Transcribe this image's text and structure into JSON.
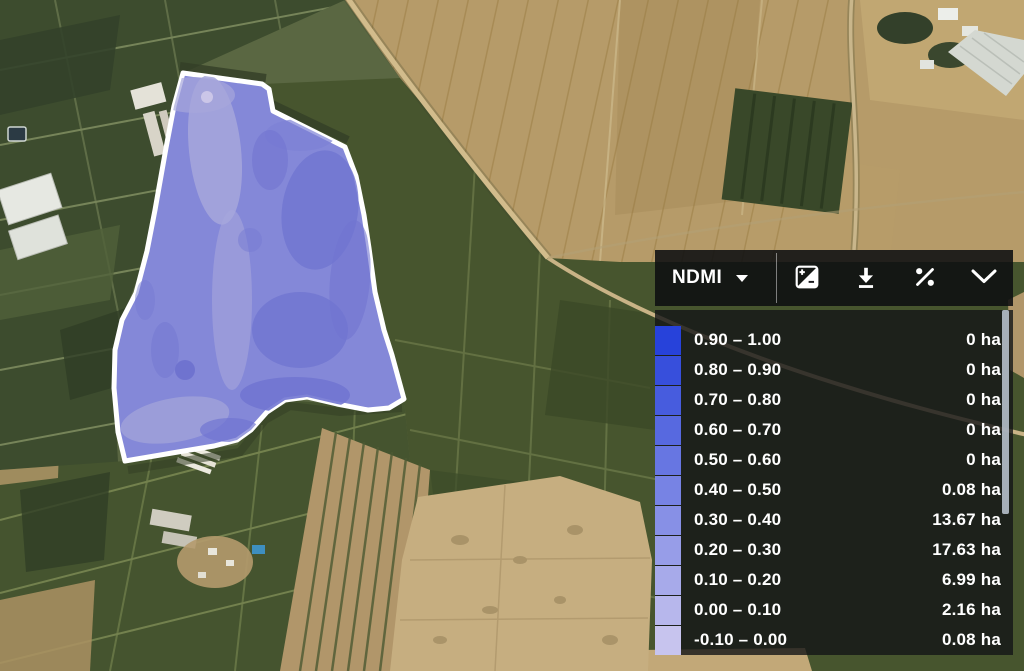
{
  "panel": {
    "layer_selector": {
      "label": "NDMI"
    },
    "toolbar": {
      "buttons": [
        {
          "name": "contrast",
          "icon": "exposure-icon"
        },
        {
          "name": "download",
          "icon": "download-icon"
        },
        {
          "name": "percent",
          "icon": "percent-icon"
        },
        {
          "name": "collapse",
          "icon": "chevron-down-icon"
        }
      ]
    },
    "legend": {
      "rows": [
        {
          "range": "0.90 – 1.00",
          "area": "0 ha",
          "color": "#2742da"
        },
        {
          "range": "0.80 – 0.90",
          "area": "0 ha",
          "color": "#374fdc"
        },
        {
          "range": "0.70 – 0.80",
          "area": "0 ha",
          "color": "#475cde"
        },
        {
          "range": "0.60 – 0.70",
          "area": "0 ha",
          "color": "#5769e0"
        },
        {
          "range": "0.50 – 0.60",
          "area": "0 ha",
          "color": "#6776e2"
        },
        {
          "range": "0.40 – 0.50",
          "area": "0.08 ha",
          "color": "#7783e4"
        },
        {
          "range": "0.30 – 0.40",
          "area": "13.67 ha",
          "color": "#8790e6"
        },
        {
          "range": "0.20 – 0.30",
          "area": "17.63 ha",
          "color": "#979de8"
        },
        {
          "range": "0.10 – 0.20",
          "area": "6.99 ha",
          "color": "#a7aaea"
        },
        {
          "range": "0.00 – 0.10",
          "area": "2.16 ha",
          "color": "#b7b7ec"
        },
        {
          "range": "-0.10 – 0.00",
          "area": "0.08 ha",
          "color": "#c7c4ee"
        }
      ]
    }
  },
  "map": {
    "overlay": {
      "fill": "#8488d8",
      "stroke": "#ffffff"
    }
  }
}
